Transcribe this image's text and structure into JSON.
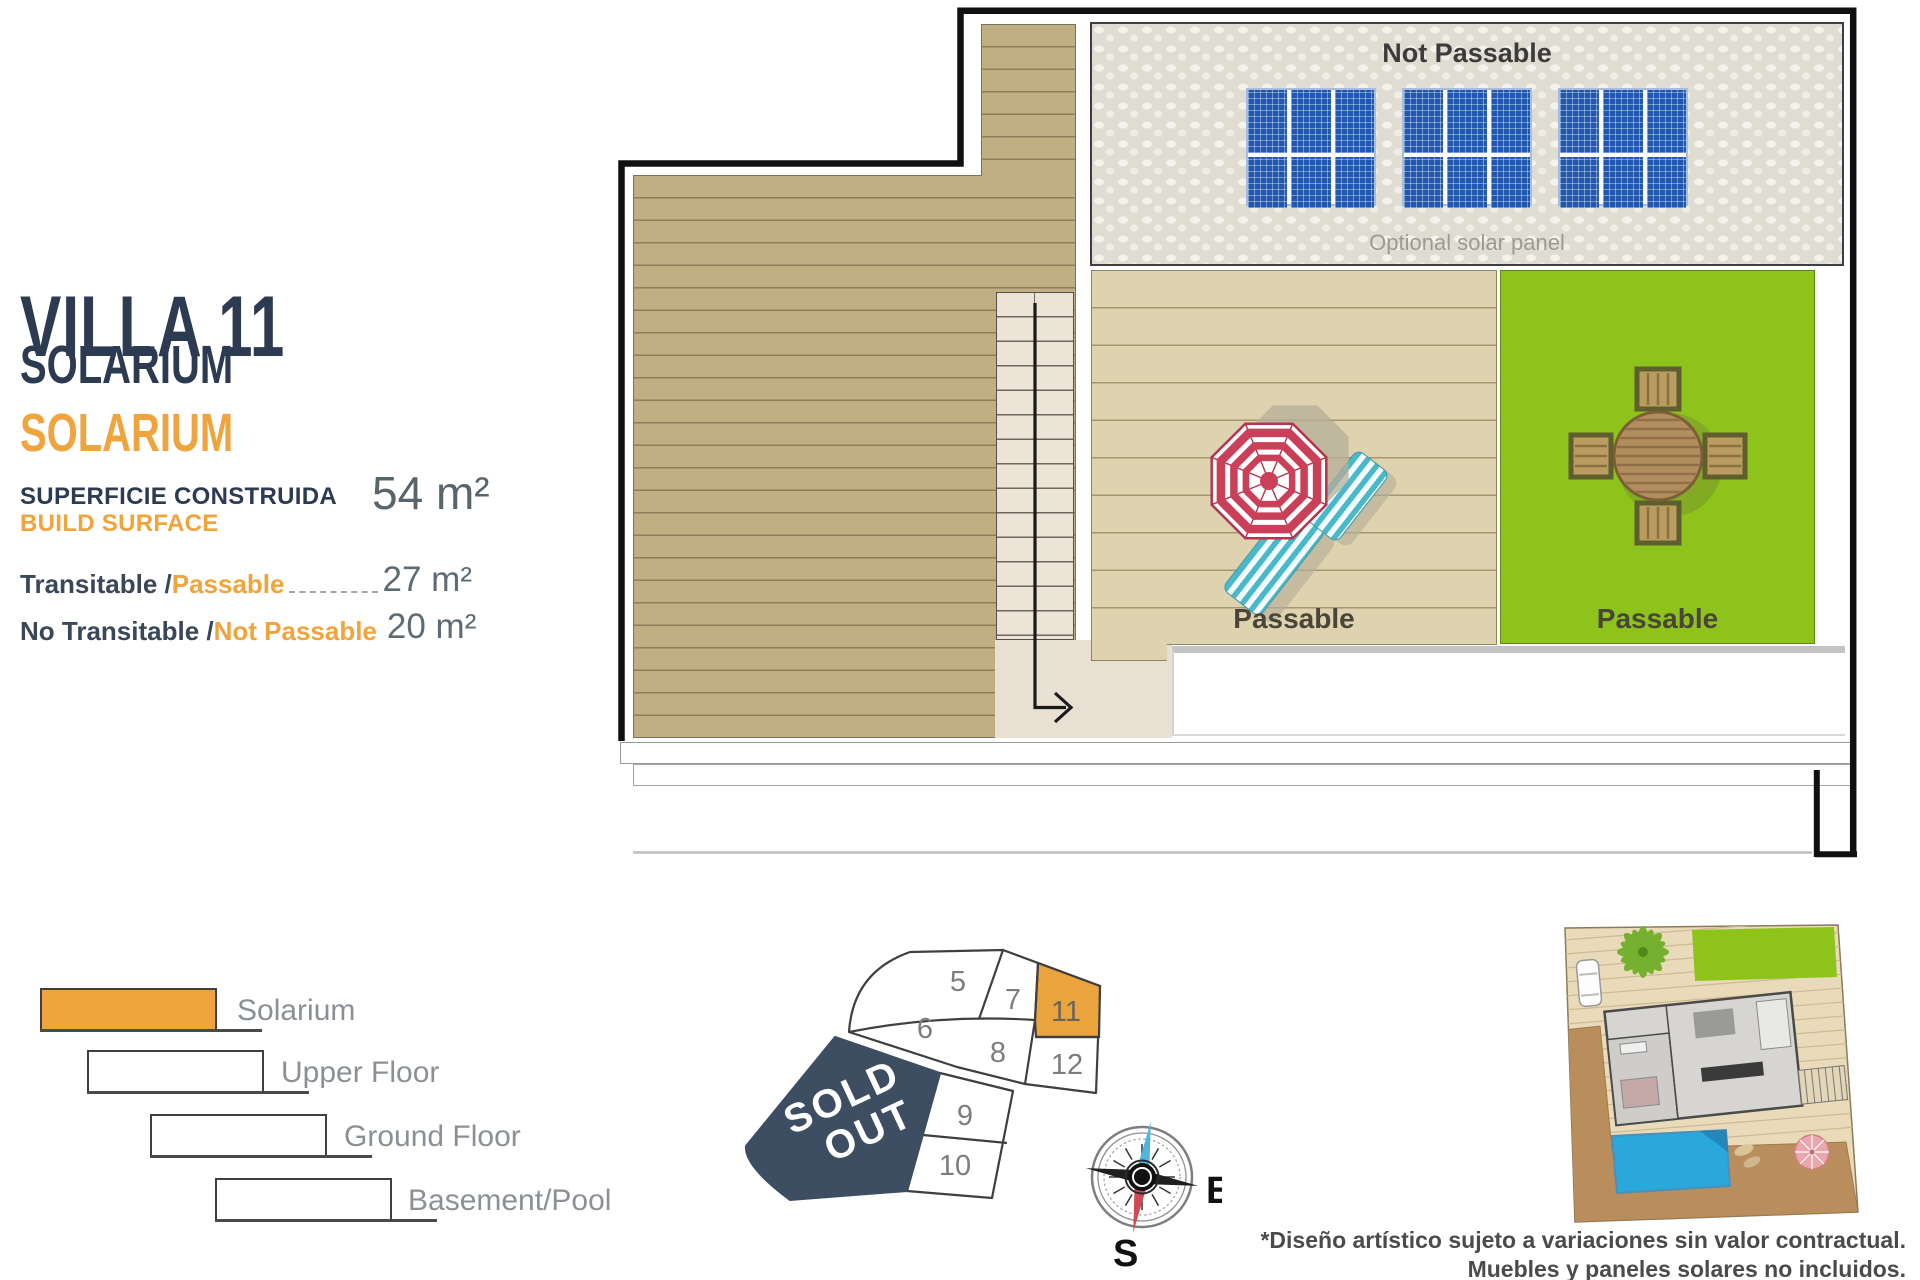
{
  "info_panel": {
    "title": "VILLA 11",
    "type_label_es": "SOLARIUM",
    "type_label_en": "SOLARIUM",
    "built_surface_label_es": "SUPERFICIE CONSTRUIDA",
    "built_surface_label_en": "BUILD SURFACE",
    "built_surface_value": "54 m²",
    "surface_rows": [
      {
        "label_es": "Transitable /",
        "label_en": "Passable",
        "value": "27 m²"
      },
      {
        "label_es": "No Transitable /",
        "label_en": "Not Passable",
        "value": "20 m²"
      }
    ]
  },
  "floor_plan": {
    "roof_area_label": "Not Passable",
    "solar_caption": "Optional solar panel",
    "deck_area_label": "Passable",
    "lawn_area_label": "Passable"
  },
  "legend": {
    "items": [
      {
        "label": "Solarium",
        "highlighted": true
      },
      {
        "label": "Upper Floor",
        "highlighted": false
      },
      {
        "label": "Ground Floor",
        "highlighted": false
      },
      {
        "label": "Basement/Pool",
        "highlighted": false
      }
    ]
  },
  "site_map": {
    "sold_out_line1": "SOLD",
    "sold_out_line2": "OUT",
    "highlighted_plot": "11",
    "plots": {
      "p5": "5",
      "p6": "6",
      "p7": "7",
      "p8": "8",
      "p9": "9",
      "p10": "10",
      "p11": "11",
      "p12": "12"
    }
  },
  "compass": {
    "east_label": "E",
    "south_label": "S"
  },
  "footnote": {
    "line1": "*Diseño artístico sujeto a variaciones sin valor contractual.",
    "line2": "Muebles y paneles solares no incluidos."
  },
  "colors": {
    "navy": "#2c3a52",
    "orange": "#efa43d",
    "deck_dark": "#c1af84",
    "deck_light": "#ded3ae",
    "lawn_green": "#8ec31c",
    "solar_blue": "#1f58ae",
    "sold_out_navy": "#3d4e63",
    "umbrella_red": "#c74058",
    "lounger_teal": "#49b9c9"
  }
}
